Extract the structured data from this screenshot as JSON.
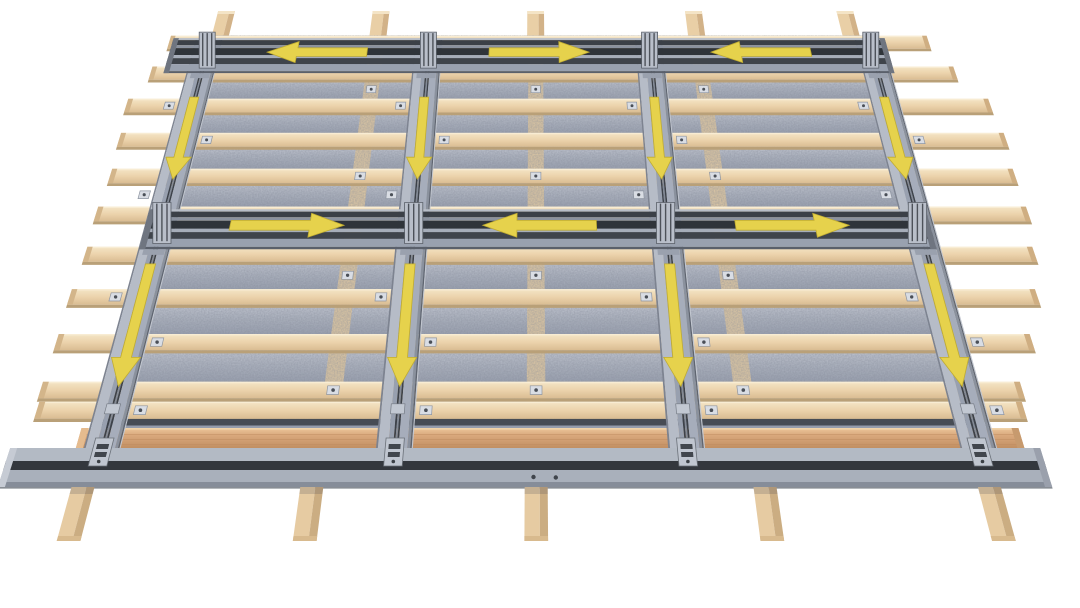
{
  "diagram": {
    "kind": "roof-mounting-rail-installation-illustration",
    "background_color": "#ffffff",
    "substructure": {
      "rafter_count": 5,
      "batten_row_count": 11,
      "batten_color": "#ecd3ac",
      "batten_shade_color": "#d9bc92",
      "membrane_color": "#a7aebc",
      "membrane_light_color": "#c9cdd7",
      "eave_plank_color": "#d9a87c"
    },
    "rail_system": {
      "vertical_rail_count": 4,
      "horizontal_rail_row_count": 2,
      "panel_columns": 3,
      "panel_rows": 2,
      "vertical_rail_color": "#9aa2b1",
      "horizontal_rail_color": "#3b4047",
      "clamp_color": "#c0c6d0",
      "eave_profile_color": "#a9b0bb",
      "eave_profile_lip_color": "#33373d"
    },
    "arrows": {
      "color": "#e6d24c",
      "edge_color": "#c0ac31",
      "horizontal": [
        {
          "row": 1,
          "col": 1,
          "dir": "left"
        },
        {
          "row": 1,
          "col": 2,
          "dir": "right"
        },
        {
          "row": 1,
          "col": 3,
          "dir": "left"
        },
        {
          "row": 2,
          "col": 1,
          "dir": "right"
        },
        {
          "row": 2,
          "col": 2,
          "dir": "left"
        },
        {
          "row": 2,
          "col": 3,
          "dir": "right"
        }
      ],
      "vertical": [
        {
          "row": 1,
          "rail": 1,
          "dir": "down"
        },
        {
          "row": 1,
          "rail": 2,
          "dir": "down"
        },
        {
          "row": 1,
          "rail": 3,
          "dir": "down"
        },
        {
          "row": 1,
          "rail": 4,
          "dir": "down"
        },
        {
          "row": 2,
          "rail": 1,
          "dir": "down"
        },
        {
          "row": 2,
          "rail": 2,
          "dir": "down"
        },
        {
          "row": 2,
          "rail": 3,
          "dir": "down"
        },
        {
          "row": 2,
          "rail": 4,
          "dir": "down"
        }
      ]
    }
  }
}
